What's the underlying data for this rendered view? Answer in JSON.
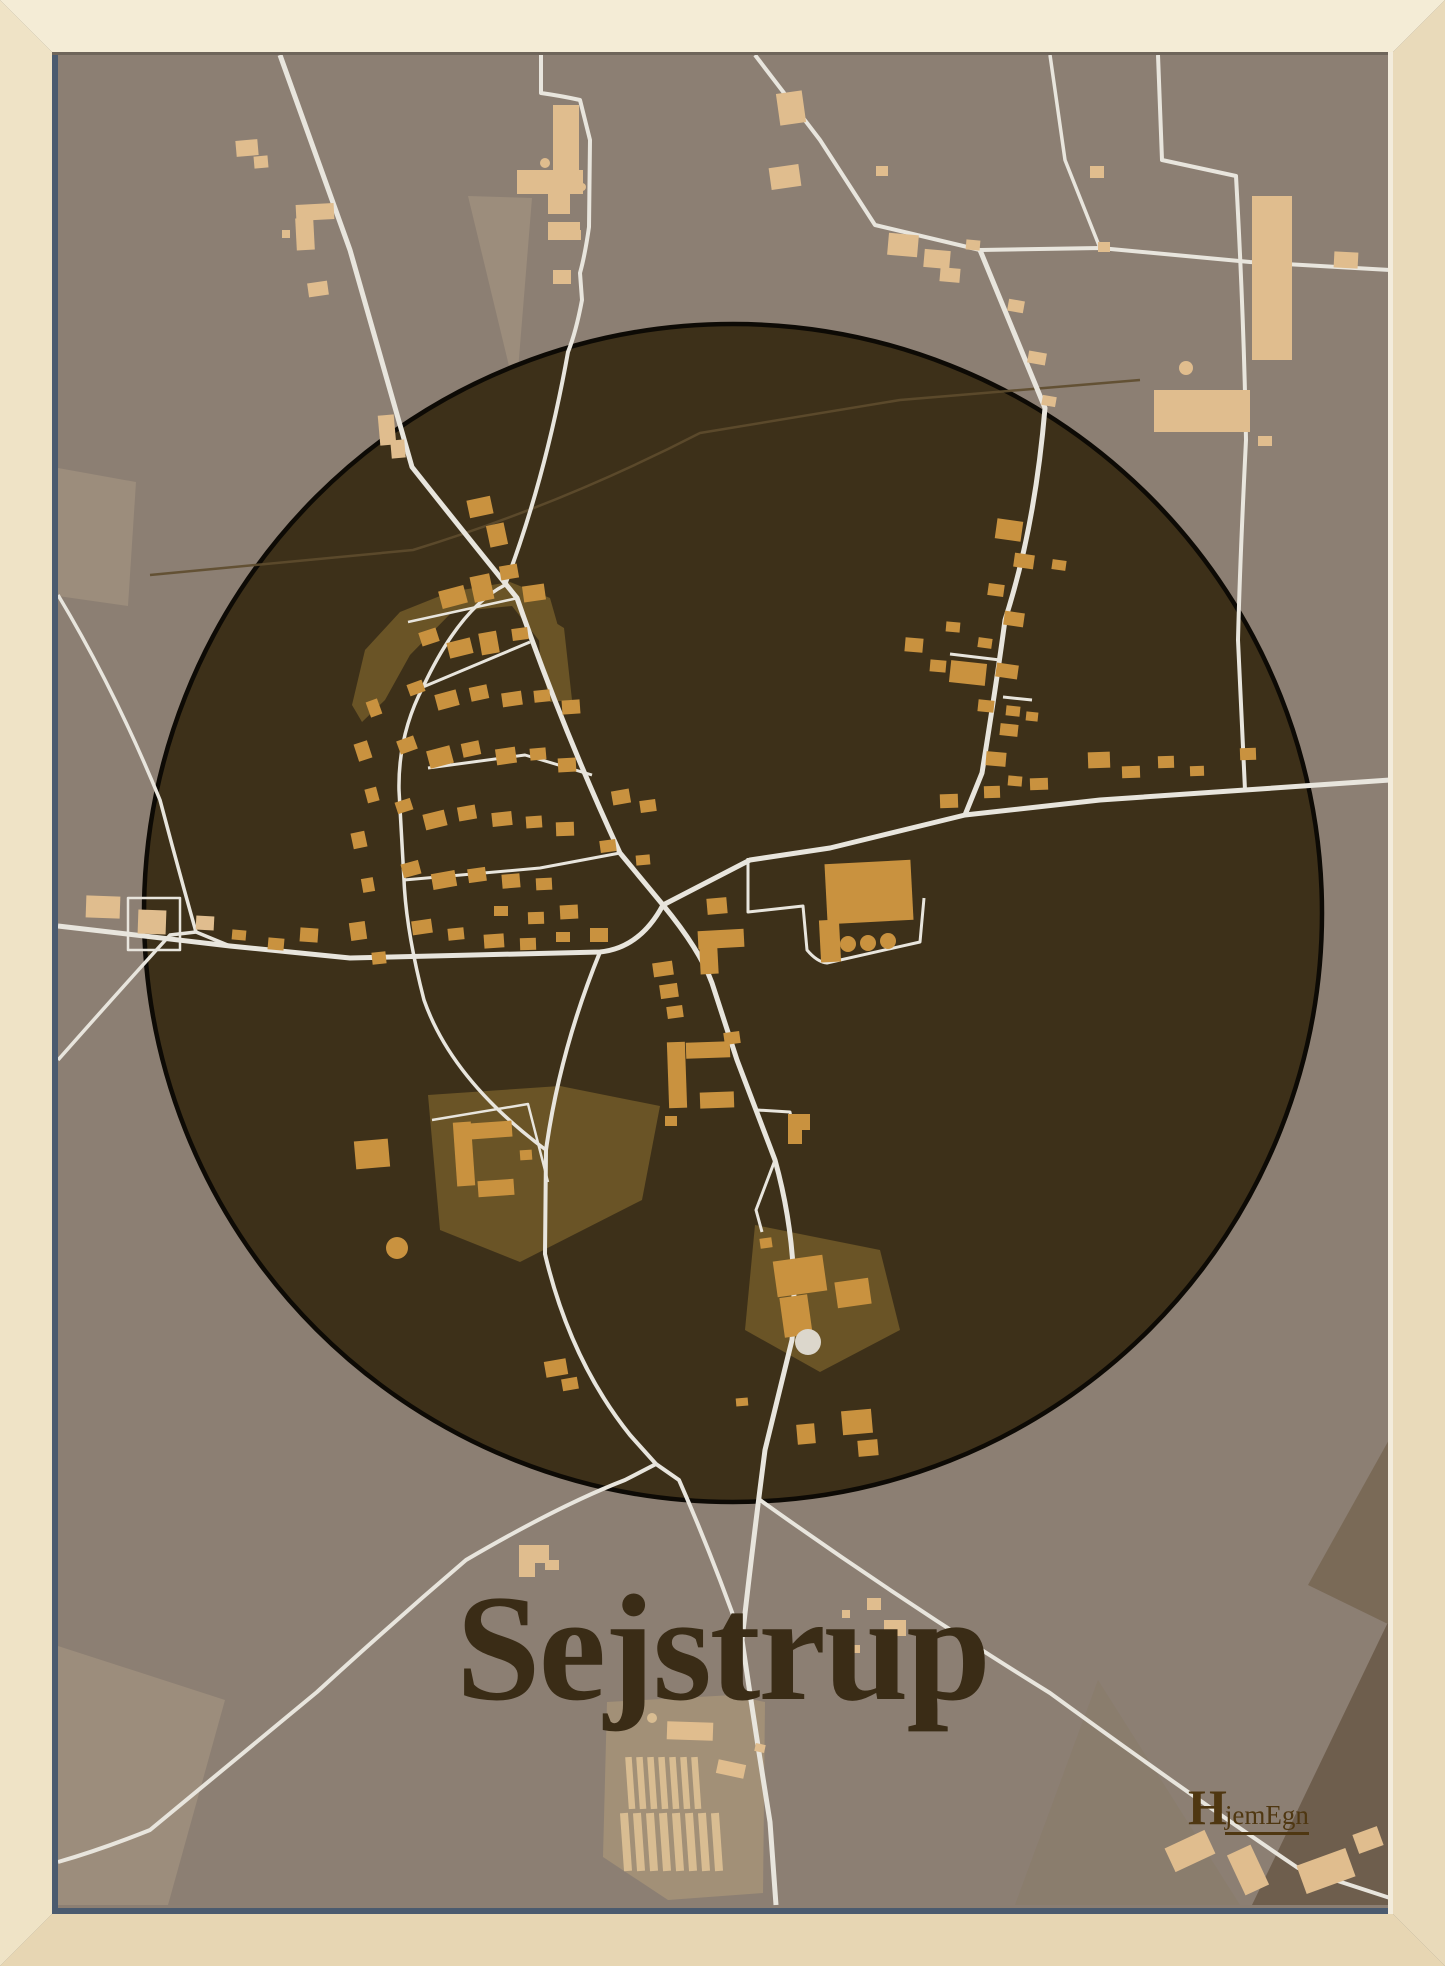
{
  "poster": {
    "title": "Sejstrup",
    "brand": {
      "initial": "H",
      "rest": "jemEgn"
    }
  },
  "colors": {
    "bg": "#8c7f73",
    "circleFill": "#3d3019",
    "circleStroke": "#0d0a05",
    "road": "#e8e5dd",
    "faint": "#5e4c2e",
    "bIn": "#c9923f",
    "bOut": "#e0bd8e",
    "olive": "#6a5426",
    "fieldLight": "#9c8d7c",
    "fieldLighter": "#a29077",
    "darkCorner": "#6e5e4d",
    "darkWedge": "#7a6a57",
    "subtle": "#8a7d6d",
    "bar": "#d9bd92",
    "white": "#dcd7cc",
    "title": "#3a2c16",
    "logo": "#4f3711",
    "frameTop": "#f4ecd6",
    "frameLeft": "#efe3c6",
    "frameRight": "#e9daba",
    "frameBottom": "#e7d6b3",
    "slate": "#4b5b6f",
    "topShadow": "#6e655a",
    "highlight": "#f3ecdc"
  },
  "map": {
    "view": {
      "w": 1445,
      "h": 1966,
      "inset": 52
    },
    "circle": {
      "cx": 733,
      "cy": 913,
      "r": 589
    },
    "fields": [
      {
        "points": "468,196 532,198 516,395",
        "fill": "fieldLight"
      },
      {
        "points": "58,468 136,482 128,606 58,596",
        "fill": "fieldLight"
      },
      {
        "points": "58,1646 225,1700 168,1905 58,1905",
        "fill": "fieldLight"
      },
      {
        "points": "607,1702 733,1695 765,1702 763,1893 668,1900 603,1857",
        "fill": "fieldLighter"
      },
      {
        "points": "1015,1905 1098,1680 1240,1905",
        "fill": "subtle"
      },
      {
        "points": "1252,1905 1390,1618 1390,1905",
        "fill": "darkCorner"
      },
      {
        "points": "1390,1438 1308,1585 1390,1625",
        "fill": "darkWedge"
      }
    ],
    "olives": [
      "352,705 365,650 400,612 450,592 510,582 550,598 562,640 548,652 512,606 452,612 410,655 385,700 362,722",
      "538,612 564,628 572,700 550,702 540,660",
      "428,1095 560,1086 660,1106 642,1200 520,1262 440,1230",
      "755,1225 880,1250 900,1330 820,1372 745,1330"
    ],
    "faintPaths": [
      {
        "d": "M150,575 L413,550 Q560,505 700,433 L900,400 L1140,380",
        "w": 2.5
      }
    ],
    "roads": [
      {
        "d": "M280,55 L350,250 L412,467 Q470,540 517,598 Q563,730 620,853 L663,905",
        "w": 5
      },
      {
        "d": "M541,49 L541,93 Q562,96 580,100 L590,140 L589,227 Q585,255 580,273 L582,300 Q576,332 568,352 Q545,480 505,585",
        "w": 4
      },
      {
        "d": "M663,905 Q640,948 600,952 L350,958 L230,946 L58,926",
        "w": 5
      },
      {
        "d": "M663,905 L750,860 L830,848 L965,815 L1100,800 L1245,790 L1390,780",
        "w": 5
      },
      {
        "d": "M980,250 L1045,408 Q1035,527 1005,620 Q997,680 982,773 L965,815",
        "w": 5
      },
      {
        "d": "M755,55 L820,140 L875,225 L980,250",
        "w": 4
      },
      {
        "d": "M980,250 L1100,248 L1250,262 L1390,270",
        "w": 4
      },
      {
        "d": "M1100,248 L1065,160 L1050,55",
        "w": 3.5
      },
      {
        "d": "M1158,55 L1162,160 L1236,176 Q1244,320 1246,440 Q1240,560 1238,640 L1245,790",
        "w": 4
      },
      {
        "d": "M663,905 Q700,950 712,983 L737,1060 L775,1160 Q800,1250 792,1340 L765,1450 Q752,1550 742,1640 Q756,1735 770,1822 L776,1905",
        "w": 5
      },
      {
        "d": "M600,952 Q560,1050 546,1150 L545,1254 Q570,1360 630,1435 L656,1464",
        "w": 4
      },
      {
        "d": "M656,1464 L679,1480 Q712,1555 742,1640",
        "w": 4
      },
      {
        "d": "M656,1464 L625,1480 Q560,1505 466,1560 Q390,1625 317,1692 L150,1830 Q100,1850 58,1862",
        "w": 4
      },
      {
        "d": "M760,1500 Q900,1600 1050,1693 Q1180,1788 1298,1868 L1390,1898",
        "w": 4
      },
      {
        "d": "M58,595 Q115,690 160,800 Q178,868 196,932",
        "w": 3.5
      },
      {
        "d": "M58,1060 Q120,990 170,935 L196,932 L230,946",
        "w": 3.5
      },
      {
        "d": "M505,585 Q460,608 423,687 Q398,735 399,790 L404,880 Q406,930 424,1000 Q452,1080 546,1150",
        "w": 3.5
      },
      {
        "d": "M423,687 L530,642",
        "w": 3
      },
      {
        "d": "M428,768 L525,755 L592,775",
        "w": 3
      },
      {
        "d": "M404,880 L540,868 L620,853",
        "w": 3
      },
      {
        "d": "M1000,660 L950,654",
        "w": 3
      },
      {
        "d": "M1003,697 L1032,700",
        "w": 3
      },
      {
        "d": "M757,1110 L790,1112 L793,1130",
        "w": 3
      },
      {
        "d": "M775,1160 L756,1210 L762,1232",
        "w": 3
      }
    ],
    "outlines": [
      {
        "d": "M748,858 L748,912 L803,906 L807,950 Q817,962 827,963 L920,942 L924,898",
        "w": 3
      },
      {
        "d": "M128,898 L180,898 L180,950 L128,950 Z",
        "w": 2.5
      },
      {
        "d": "M432,1120 L528,1104 L548,1182",
        "w": 2.5
      },
      {
        "d": "M408,622 L518,598",
        "w": 2.5
      }
    ],
    "buildingsOut": [
      [
        296,
        204,
        38,
        16,
        -3
      ],
      [
        296,
        218,
        18,
        32,
        -3
      ],
      [
        282,
        230,
        8,
        8,
        0
      ],
      [
        236,
        140,
        22,
        16,
        -5
      ],
      [
        254,
        156,
        14,
        12,
        -5
      ],
      [
        308,
        282,
        20,
        14,
        -8
      ],
      [
        379,
        415,
        16,
        30,
        -5
      ],
      [
        391,
        440,
        14,
        18,
        -5
      ],
      [
        553,
        105,
        26,
        66,
        0
      ],
      [
        517,
        170,
        66,
        24,
        0
      ],
      [
        548,
        192,
        22,
        22,
        0
      ],
      [
        548,
        222,
        32,
        18,
        0
      ],
      [
        569,
        230,
        12,
        10,
        0
      ],
      [
        553,
        270,
        18,
        14,
        0
      ],
      [
        778,
        92,
        26,
        32,
        -8
      ],
      [
        770,
        166,
        30,
        22,
        -8
      ],
      [
        876,
        166,
        12,
        10,
        0
      ],
      [
        888,
        234,
        30,
        22,
        5
      ],
      [
        924,
        250,
        26,
        18,
        5
      ],
      [
        940,
        268,
        20,
        14,
        5
      ],
      [
        966,
        240,
        14,
        10,
        5
      ],
      [
        1008,
        300,
        16,
        12,
        10
      ],
      [
        1028,
        352,
        18,
        12,
        10
      ],
      [
        1042,
        396,
        14,
        10,
        10
      ],
      [
        1090,
        166,
        14,
        12,
        0
      ],
      [
        1098,
        242,
        12,
        10,
        0
      ],
      [
        1252,
        196,
        40,
        164,
        0
      ],
      [
        1154,
        390,
        96,
        42,
        0
      ],
      [
        1258,
        436,
        14,
        10,
        0
      ],
      [
        1334,
        252,
        24,
        16,
        3
      ],
      [
        86,
        896,
        34,
        22,
        2
      ],
      [
        138,
        910,
        28,
        24,
        2
      ],
      [
        196,
        916,
        18,
        14,
        3
      ],
      [
        519,
        1545,
        30,
        18,
        0
      ],
      [
        519,
        1557,
        16,
        20,
        0
      ],
      [
        545,
        1560,
        14,
        10,
        0
      ],
      [
        867,
        1598,
        14,
        12,
        0
      ],
      [
        884,
        1620,
        22,
        16,
        0
      ],
      [
        850,
        1645,
        10,
        8,
        0
      ],
      [
        842,
        1610,
        8,
        8,
        0
      ],
      [
        667,
        1722,
        46,
        18,
        2
      ],
      [
        717,
        1762,
        28,
        14,
        12
      ],
      [
        755,
        1744,
        10,
        8,
        12
      ],
      [
        1168,
        1838,
        44,
        26,
        -25
      ],
      [
        1235,
        1848,
        26,
        44,
        -25
      ],
      [
        1300,
        1856,
        52,
        30,
        -20
      ],
      [
        1355,
        1830,
        26,
        20,
        -20
      ]
    ],
    "buildingsIn": [
      [
        440,
        588,
        26,
        18,
        -15
      ],
      [
        472,
        575,
        20,
        26,
        -12
      ],
      [
        500,
        565,
        18,
        14,
        -10
      ],
      [
        523,
        585,
        22,
        16,
        -8
      ],
      [
        468,
        498,
        24,
        18,
        -12
      ],
      [
        488,
        524,
        18,
        22,
        -12
      ],
      [
        420,
        630,
        18,
        14,
        -18
      ],
      [
        448,
        640,
        24,
        16,
        -14
      ],
      [
        480,
        632,
        18,
        22,
        -10
      ],
      [
        512,
        628,
        16,
        12,
        -8
      ],
      [
        408,
        682,
        16,
        12,
        -20
      ],
      [
        436,
        692,
        22,
        16,
        -15
      ],
      [
        470,
        686,
        18,
        14,
        -12
      ],
      [
        502,
        692,
        20,
        14,
        -8
      ],
      [
        534,
        690,
        16,
        12,
        -6
      ],
      [
        562,
        700,
        18,
        14,
        -4
      ],
      [
        398,
        738,
        18,
        14,
        -20
      ],
      [
        428,
        748,
        24,
        18,
        -15
      ],
      [
        462,
        742,
        18,
        14,
        -12
      ],
      [
        496,
        748,
        20,
        16,
        -8
      ],
      [
        530,
        748,
        16,
        12,
        -5
      ],
      [
        558,
        758,
        18,
        14,
        -3
      ],
      [
        396,
        800,
        16,
        12,
        -18
      ],
      [
        424,
        812,
        22,
        16,
        -14
      ],
      [
        458,
        806,
        18,
        14,
        -10
      ],
      [
        492,
        812,
        20,
        14,
        -6
      ],
      [
        526,
        816,
        16,
        12,
        -4
      ],
      [
        556,
        822,
        18,
        14,
        -2
      ],
      [
        402,
        862,
        18,
        14,
        -15
      ],
      [
        432,
        872,
        24,
        16,
        -10
      ],
      [
        468,
        868,
        18,
        14,
        -8
      ],
      [
        502,
        874,
        18,
        14,
        -5
      ],
      [
        536,
        878,
        16,
        12,
        -3
      ],
      [
        368,
        700,
        12,
        16,
        -20
      ],
      [
        356,
        742,
        14,
        18,
        -18
      ],
      [
        366,
        788,
        12,
        14,
        -15
      ],
      [
        352,
        832,
        14,
        16,
        -12
      ],
      [
        362,
        878,
        12,
        14,
        -10
      ],
      [
        350,
        922,
        16,
        18,
        -8
      ],
      [
        372,
        952,
        14,
        12,
        -6
      ],
      [
        412,
        920,
        20,
        14,
        -8
      ],
      [
        448,
        928,
        16,
        12,
        -6
      ],
      [
        484,
        934,
        20,
        14,
        -4
      ],
      [
        520,
        938,
        16,
        12,
        -2
      ],
      [
        556,
        932,
        14,
        10,
        0
      ],
      [
        590,
        928,
        18,
        14,
        0
      ],
      [
        707,
        898,
        20,
        16,
        -5
      ],
      [
        698,
        930,
        46,
        18,
        -3
      ],
      [
        700,
        948,
        18,
        26,
        -3
      ],
      [
        653,
        962,
        20,
        14,
        -8
      ],
      [
        660,
        984,
        18,
        14,
        -8
      ],
      [
        667,
        1006,
        16,
        12,
        -8
      ],
      [
        612,
        790,
        18,
        14,
        -10
      ],
      [
        640,
        800,
        16,
        12,
        -8
      ],
      [
        600,
        840,
        16,
        12,
        -8
      ],
      [
        636,
        855,
        14,
        10,
        -5
      ],
      [
        560,
        905,
        18,
        14,
        -3
      ],
      [
        528,
        912,
        16,
        12,
        -2
      ],
      [
        494,
        906,
        14,
        10,
        0
      ],
      [
        300,
        928,
        18,
        14,
        4
      ],
      [
        268,
        938,
        16,
        12,
        5
      ],
      [
        232,
        930,
        14,
        10,
        5
      ],
      [
        668,
        1042,
        18,
        66,
        -2
      ],
      [
        686,
        1042,
        44,
        16,
        -2
      ],
      [
        700,
        1092,
        34,
        16,
        -2
      ],
      [
        665,
        1116,
        12,
        10,
        0
      ],
      [
        788,
        1114,
        22,
        16,
        0
      ],
      [
        788,
        1130,
        14,
        14,
        0
      ],
      [
        724,
        1032,
        16,
        12,
        -8
      ],
      [
        826,
        862,
        86,
        60,
        -3
      ],
      [
        820,
        920,
        20,
        42,
        -3
      ],
      [
        996,
        520,
        26,
        20,
        8
      ],
      [
        1014,
        554,
        20,
        14,
        8
      ],
      [
        988,
        584,
        16,
        12,
        8
      ],
      [
        1004,
        612,
        20,
        14,
        8
      ],
      [
        978,
        638,
        14,
        10,
        8
      ],
      [
        996,
        664,
        22,
        14,
        8
      ],
      [
        950,
        662,
        36,
        22,
        6
      ],
      [
        978,
        700,
        16,
        12,
        6
      ],
      [
        1006,
        706,
        14,
        10,
        6
      ],
      [
        1026,
        712,
        12,
        9,
        6
      ],
      [
        1000,
        724,
        18,
        12,
        6
      ],
      [
        986,
        752,
        20,
        14,
        5
      ],
      [
        1008,
        776,
        14,
        10,
        5
      ],
      [
        1052,
        560,
        14,
        10,
        8
      ],
      [
        905,
        638,
        18,
        14,
        5
      ],
      [
        930,
        660,
        16,
        12,
        5
      ],
      [
        946,
        622,
        14,
        10,
        5
      ],
      [
        940,
        794,
        18,
        14,
        -2
      ],
      [
        984,
        786,
        16,
        12,
        -2
      ],
      [
        1030,
        778,
        18,
        12,
        -2
      ],
      [
        1088,
        752,
        22,
        16,
        -2
      ],
      [
        1122,
        766,
        18,
        12,
        -2
      ],
      [
        1158,
        756,
        16,
        12,
        -2
      ],
      [
        1190,
        766,
        14,
        10,
        -2
      ],
      [
        1240,
        748,
        16,
        12,
        -2
      ],
      [
        455,
        1122,
        18,
        64,
        -4
      ],
      [
        470,
        1122,
        42,
        16,
        -4
      ],
      [
        478,
        1180,
        36,
        16,
        -4
      ],
      [
        520,
        1150,
        12,
        10,
        -4
      ],
      [
        775,
        1258,
        50,
        36,
        -8
      ],
      [
        782,
        1296,
        28,
        40,
        -8
      ],
      [
        836,
        1280,
        34,
        26,
        -8
      ],
      [
        760,
        1238,
        12,
        10,
        -8
      ],
      [
        355,
        1140,
        34,
        28,
        -5
      ],
      [
        545,
        1360,
        22,
        16,
        -10
      ],
      [
        562,
        1378,
        16,
        12,
        -10
      ],
      [
        797,
        1424,
        18,
        20,
        -5
      ],
      [
        842,
        1410,
        30,
        24,
        -5
      ],
      [
        858,
        1440,
        20,
        16,
        -5
      ],
      [
        736,
        1398,
        12,
        8,
        -5
      ]
    ],
    "bars": [
      [
        627,
        1757,
        6.5,
        52,
        -4
      ],
      [
        638,
        1757,
        6.5,
        52,
        -4
      ],
      [
        649,
        1757,
        6.5,
        52,
        -4
      ],
      [
        660,
        1757,
        6.5,
        52,
        -4
      ],
      [
        671,
        1757,
        6.5,
        52,
        -4
      ],
      [
        682,
        1757,
        6.5,
        52,
        -4
      ],
      [
        693,
        1757,
        6.5,
        52,
        -4
      ],
      [
        622,
        1813,
        8,
        58,
        -4
      ],
      [
        635,
        1813,
        8,
        58,
        -4
      ],
      [
        648,
        1813,
        8,
        58,
        -4
      ],
      [
        661,
        1813,
        8,
        58,
        -4
      ],
      [
        674,
        1813,
        8,
        58,
        -4
      ],
      [
        687,
        1813,
        8,
        58,
        -4
      ],
      [
        700,
        1813,
        8,
        58,
        -4
      ],
      [
        713,
        1813,
        8,
        58,
        -4
      ]
    ],
    "dots": [
      [
        545,
        163,
        5,
        "bOut"
      ],
      [
        582,
        187,
        4,
        "bOut"
      ],
      [
        1186,
        368,
        7,
        "bOut"
      ],
      [
        848,
        944,
        8,
        "bIn"
      ],
      [
        868,
        943,
        8,
        "bIn"
      ],
      [
        888,
        941,
        8,
        "bIn"
      ],
      [
        397,
        1248,
        11,
        "bIn"
      ],
      [
        808,
        1342,
        13,
        "white"
      ],
      [
        652,
        1718,
        5,
        "bar"
      ]
    ]
  }
}
